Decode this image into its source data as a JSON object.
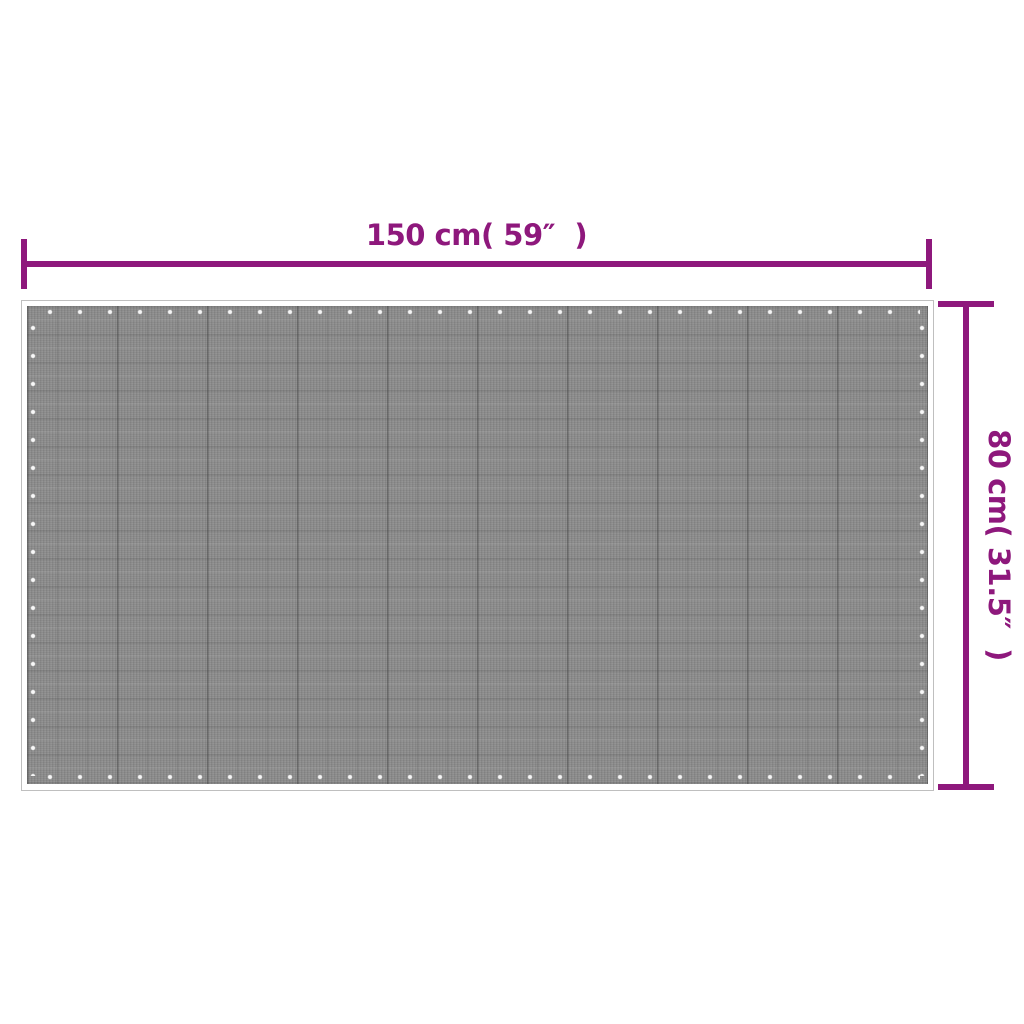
{
  "diagram": {
    "type": "product-dimension-diagram",
    "width_label": "150 cm( 59″  )",
    "height_label": "80 cm( 31.5″  )"
  },
  "colors": {
    "accent": "#8e187c",
    "background": "#ffffff",
    "mat-base": "#8c8c8c",
    "mat-border": "#bfbfbf"
  }
}
